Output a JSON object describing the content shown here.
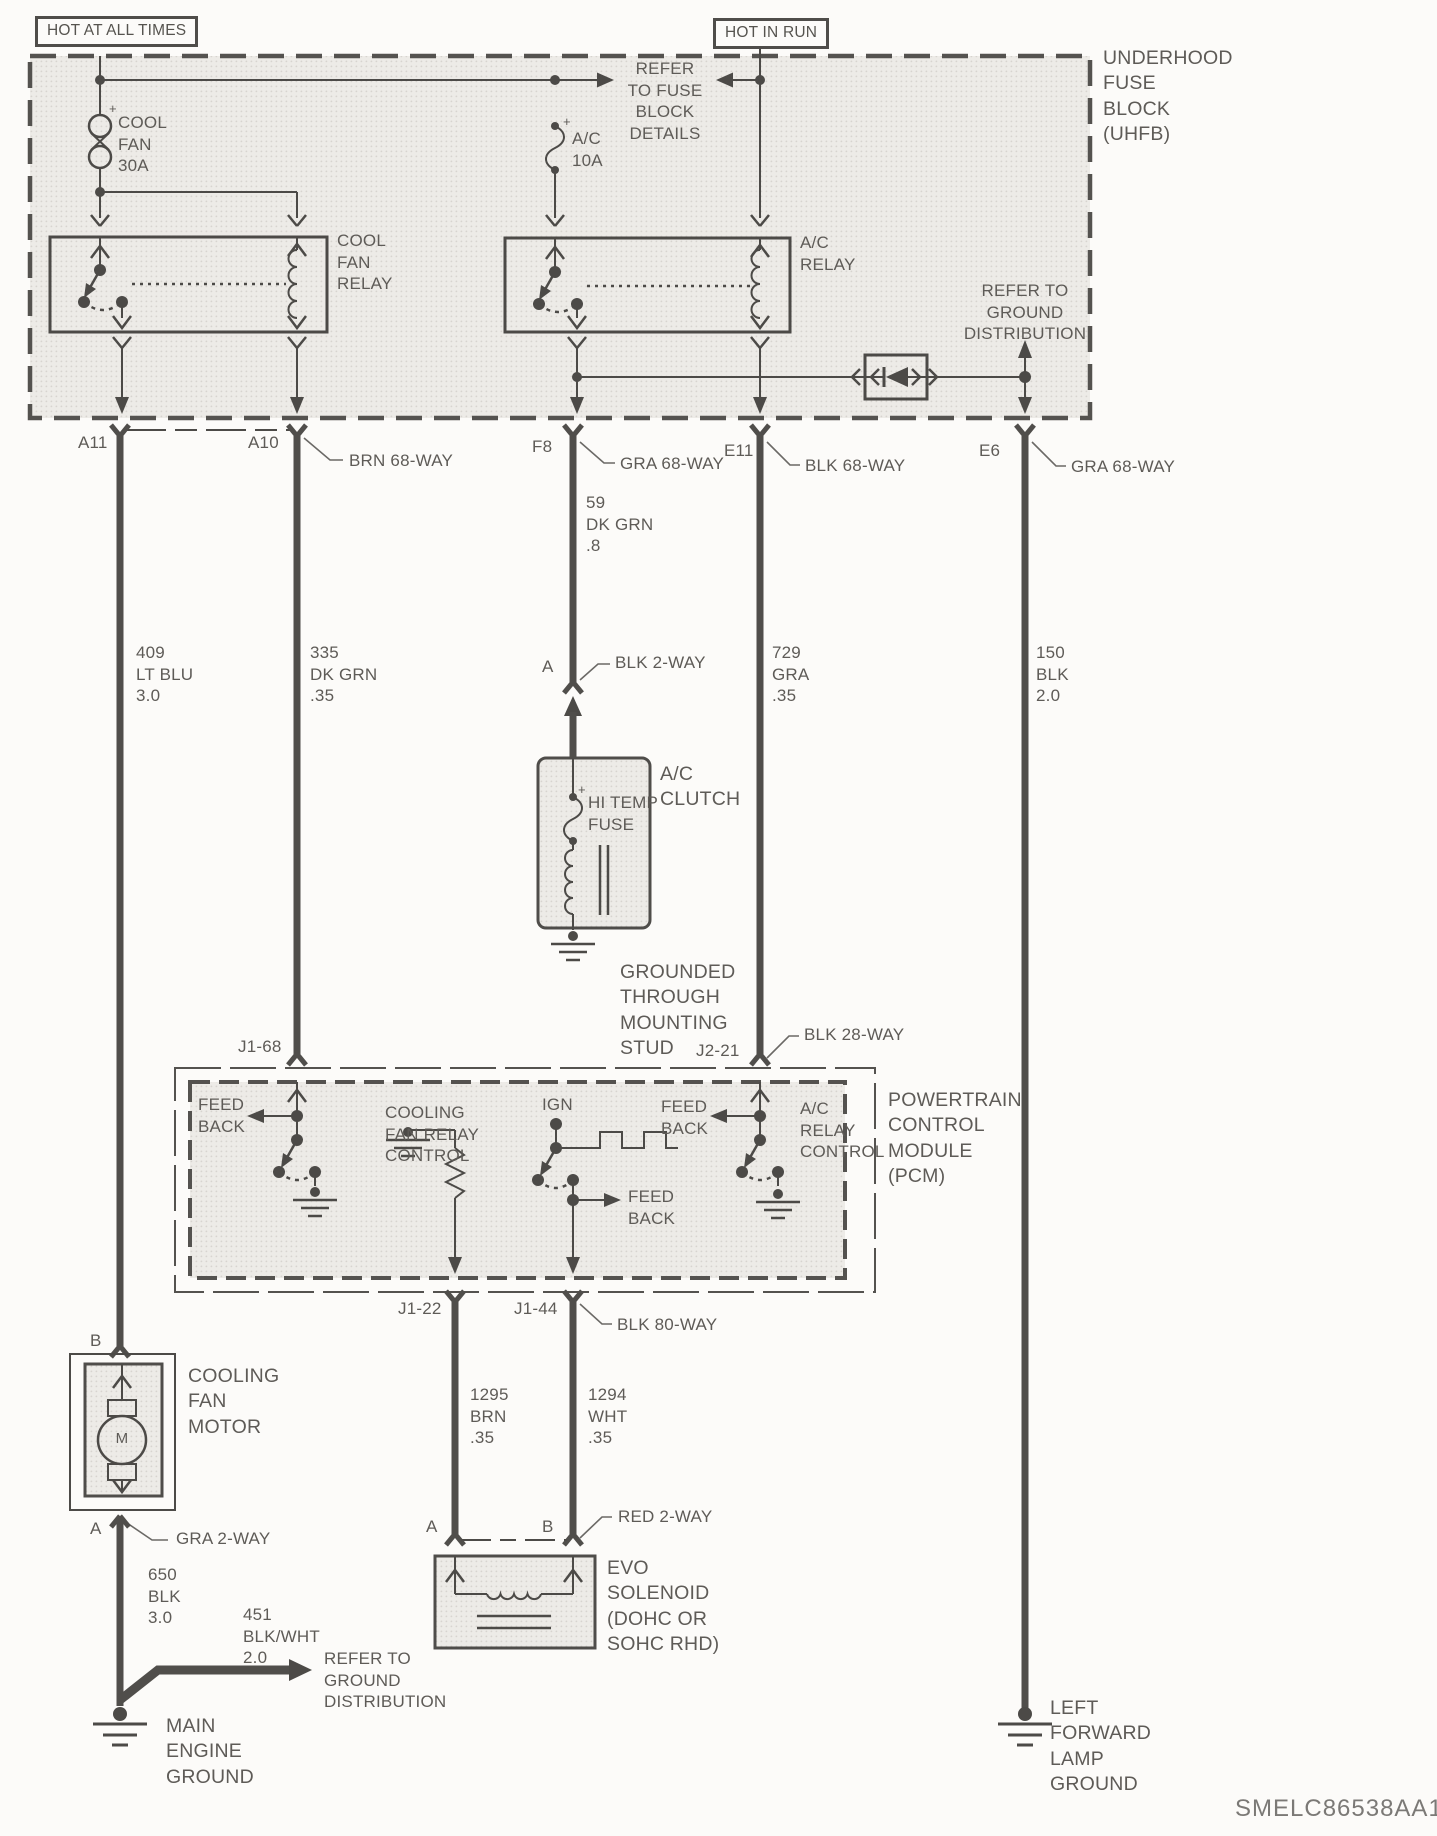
{
  "header": {
    "hot_at_all_times": "HOT AT ALL TIMES",
    "hot_in_run": "HOT IN RUN",
    "uhfb_label": "UNDERHOOD\nFUSE\nBLOCK\n(UHFB)"
  },
  "uhfb": {
    "refer_fuse_details": "REFER\nTO FUSE\nBLOCK\nDETAILS",
    "cool_fan_fuse": "COOL\nFAN\n30A",
    "ac_fuse": "A/C\n10A",
    "cool_fan_relay": "COOL\nFAN\nRELAY",
    "ac_relay": "A/C\nRELAY",
    "refer_ground": "REFER TO\nGROUND\nDISTRIBUTION",
    "plus": "+"
  },
  "connector_row": {
    "a11": "A11",
    "a10": "A10",
    "f8": "F8",
    "e11": "E11",
    "e6": "E6",
    "brn68": "BRN 68-WAY",
    "gra68_f8": "GRA 68-WAY",
    "blk68": "BLK 68-WAY",
    "gra68_e6": "GRA 68-WAY"
  },
  "wires": {
    "w409": "409\nLT BLU\n3.0",
    "w335": "335\nDK GRN\n.35",
    "w59": "59\nDK GRN\n.8",
    "w729": "729\nGRA\n.35",
    "w150": "150\nBLK\n2.0",
    "w1295": "1295\nBRN\n.35",
    "w1294": "1294\nWHT\n.35",
    "w650": "650\nBLK\n3.0",
    "w451": "451\nBLK/WHT\n2.0"
  },
  "ac_clutch": {
    "pin_a": "A",
    "conn": "BLK 2-WAY",
    "title": "A/C\nCLUTCH",
    "hi_temp_fuse": "HI TEMP\nFUSE",
    "plus": "+",
    "grounded": "GROUNDED\nTHROUGH\nMOUNTING\nSTUD"
  },
  "pcm": {
    "j1_68": "J1-68",
    "j2_21": "J2-21",
    "blk28": "BLK 28-WAY",
    "feed_back": "FEED\nBACK",
    "cfrc": "COOLING\nFAN RELAY\nCONTROL",
    "ign": "IGN",
    "acrc": "A/C\nRELAY\nCONTROL",
    "title": "POWERTRAIN\nCONTROL\nMODULE\n(PCM)",
    "j1_22": "J1-22",
    "j1_44": "J1-44",
    "blk80": "BLK 80-WAY"
  },
  "evo": {
    "pin_a": "A",
    "pin_b": "B",
    "conn": "RED 2-WAY",
    "title": "EVO\nSOLENOID\n(DOHC OR\nSOHC RHD)"
  },
  "motor": {
    "pin_b": "B",
    "pin_a": "A",
    "title": "COOLING\nFAN\nMOTOR",
    "m": "M",
    "conn": "GRA 2-WAY"
  },
  "grounds": {
    "refer_ground": "REFER TO\nGROUND\nDISTRIBUTION",
    "main_engine": "MAIN\nENGINE\nGROUND",
    "left_forward": "LEFT\nFORWARD\nLAMP\nGROUND"
  },
  "footer": {
    "doc_id": "SMELC86538AA1"
  }
}
